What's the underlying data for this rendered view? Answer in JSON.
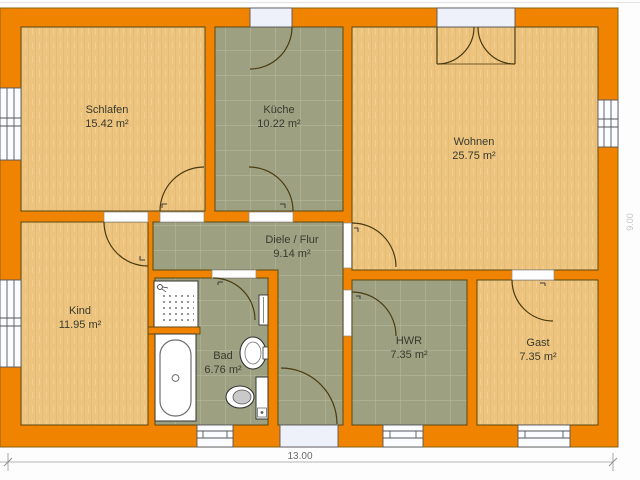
{
  "plan": {
    "title": "floor-plan",
    "rooms": [
      {
        "id": "schlafen",
        "name": "Schlafen",
        "area": "15.42 m²",
        "floor": "wood"
      },
      {
        "id": "kueche",
        "name": "Küche",
        "area": "10.22 m²",
        "floor": "tile"
      },
      {
        "id": "wohnen",
        "name": "Wohnen",
        "area": "25.75 m²",
        "floor": "wood"
      },
      {
        "id": "kind",
        "name": "Kind",
        "area": "11.95 m²",
        "floor": "wood"
      },
      {
        "id": "diele",
        "name": "Diele / Flur",
        "area": "9.14 m²",
        "floor": "tile"
      },
      {
        "id": "bad",
        "name": "Bad",
        "area": "6.76 m²",
        "floor": "tile"
      },
      {
        "id": "hwr",
        "name": "HWR",
        "area": "7.35 m²",
        "floor": "tile"
      },
      {
        "id": "gast",
        "name": "Gast",
        "area": "7.35 m²",
        "floor": "wood"
      }
    ],
    "dimensions": {
      "width_label": "13.00",
      "depth_label": "9.00"
    },
    "fixtures": [
      "shower",
      "bathtub",
      "washbasin",
      "toilet",
      "radiator"
    ],
    "colors": {
      "wall": "#f08300",
      "wood_floor": "#ecc47f",
      "tile_floor": "#9da081",
      "tile_grid": "#b7b89d",
      "outline": "#5a4712",
      "window_fill": "#f2f4fb",
      "dimension_line": "#b5b5b5"
    }
  }
}
